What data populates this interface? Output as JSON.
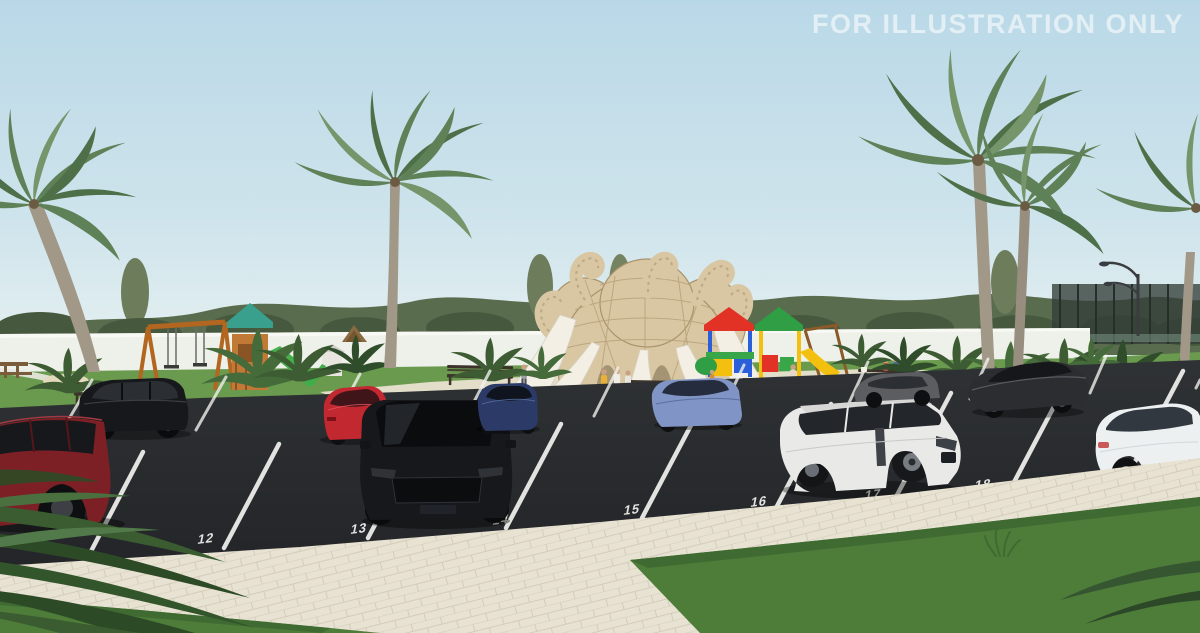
{
  "watermark": {
    "text": "FOR ILLUSTRATION ONLY"
  },
  "parking": {
    "space_numbers": [
      "12",
      "13",
      "14",
      "15",
      "16",
      "17",
      "18"
    ],
    "line_color": "#f2f2ef"
  },
  "palette": {
    "sky_top": "#b9d8e7",
    "sky_mid": "#cfe4ec",
    "sky_horizon": "#e6f1f1",
    "treeline": "#5a6c4e",
    "treeline_dark": "#46583d",
    "wall": "#eef0ea",
    "grass": "#6a9a4e",
    "grass_dark": "#4e7c39",
    "plaza": "#e9e2d0",
    "paver": "#e8e2d3",
    "asphalt": "#232528",
    "asphalt_light": "#2f3235",
    "elephant_tan": "#d8c7a2",
    "elephant_shade": "#b7a179",
    "slide_white": "#f3efe5",
    "roof_red": "#e23125",
    "roof_green": "#2f9e44",
    "roof_teal": "#38a08c",
    "swing_wood": "#b2661f",
    "bench": "#3e332b",
    "palm_leaf": "#5f8157",
    "palm_trunk": "#a19888",
    "bush": "#3d5c33",
    "lamp": "#3a3d3f",
    "car_maroon": "#7c2026",
    "car_black": "#17181b",
    "car_red": "#c22830",
    "car_navy": "#2b3a66",
    "car_periwinkle": "#8095c5",
    "car_white_suv": "#e9e9e7",
    "car_gray": "#5b5d60",
    "car_dark_sports": "#2b2d31",
    "car_white_sedan": "#edf0f1"
  }
}
